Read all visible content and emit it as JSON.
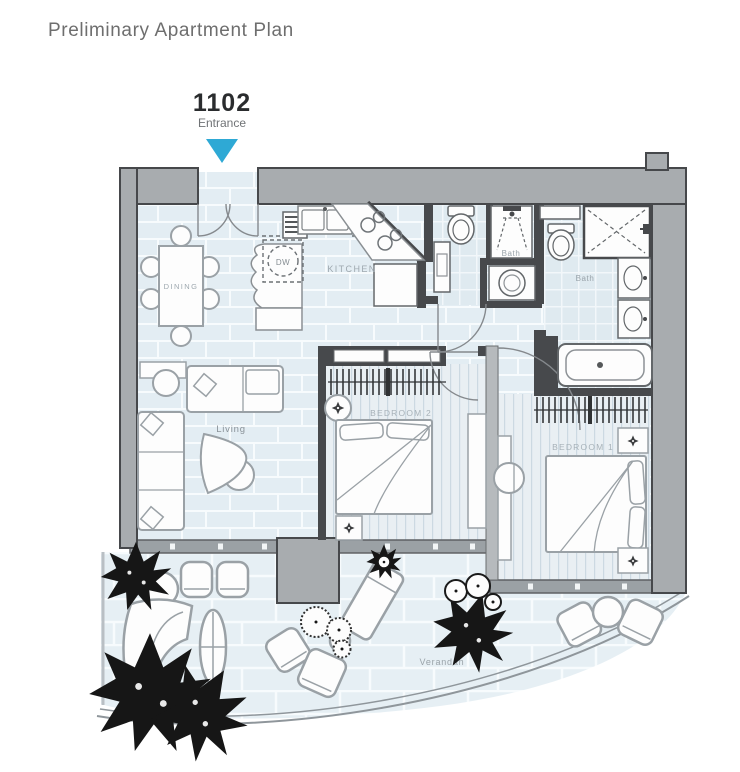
{
  "header": {
    "title": "Preliminary Apartment Plan"
  },
  "entrance_marker": {
    "unit_number": "1102",
    "label": "Entrance"
  },
  "room_labels": {
    "dining": "DINING",
    "kitchen": "KITCHEN",
    "living": "Living",
    "bedroom2": "BEDROOM 2",
    "bedroom1": "BEDROOM 1",
    "bath_guest": "Bath",
    "bath_master": "Bath",
    "verandah": "Verandah"
  },
  "appliance_labels": {
    "dishwasher": "DW"
  },
  "colors": {
    "entrance_arrow": "#2ea9d5",
    "wall_gray": "#a8acaf",
    "wall_dark": "#47494c",
    "floor_tile": "#e3edf3",
    "title_text": "#6e6e6e"
  }
}
